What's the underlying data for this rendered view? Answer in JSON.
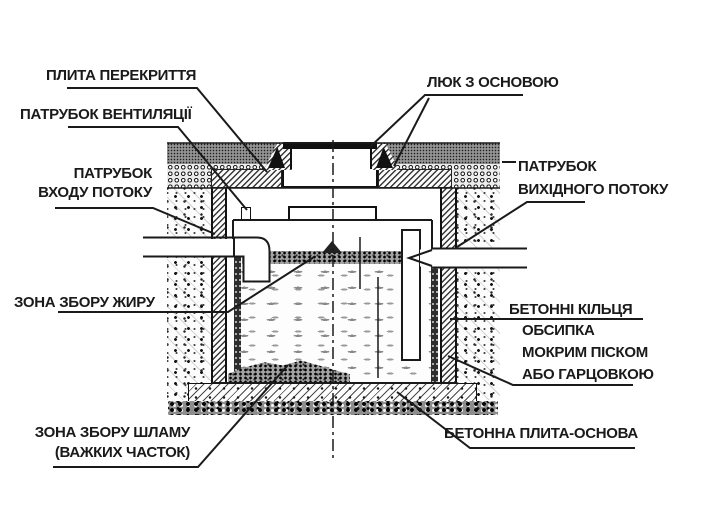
{
  "labels": {
    "cover_slab": "ПЛИТА ПЕРЕКРИТТЯ",
    "vent_pipe": "ПАТРУБОК ВЕНТИЛЯЦІЇ",
    "hatch_with_base": "ЛЮК З ОСНОВОЮ",
    "inlet_pipe": {
      "line1": "ПАТРУБОК",
      "line2": "ВХОДУ ПОТОКУ"
    },
    "outlet_pipe": {
      "line1": "ПАТРУБОК",
      "line2": "ВИХІДНОГО ПОТОКУ"
    },
    "grease_zone": "ЗОНА ЗБОРУ ЖИРУ",
    "concrete_rings": "БЕТОННІ КІЛЬЦЯ",
    "backfill": {
      "line1": "ОБСИПКА",
      "line2": "МОКРИМ ПІСКОМ",
      "line3": "АБО ГАРЦОВКОЮ"
    },
    "sludge_zone": {
      "line1": "ЗОНА ЗБОРУ ШЛАМУ",
      "line2": "(ВАЖКИХ ЧАСТОК)"
    },
    "base_slab": "БЕТОННА ПЛИТА-ОСНОВА"
  },
  "colors": {
    "ink": "#1a1a1a",
    "paper": "#ffffff"
  }
}
